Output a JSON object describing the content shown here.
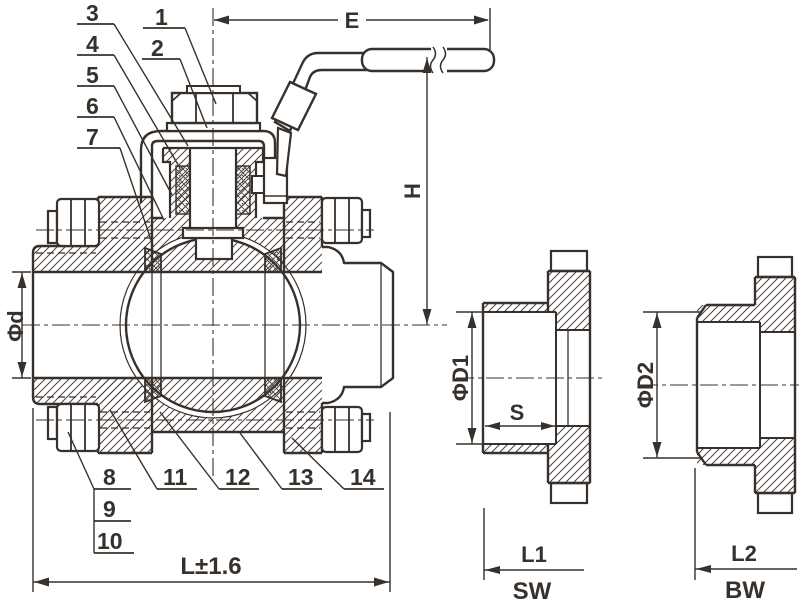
{
  "part_labels": {
    "p1": "1",
    "p2": "2",
    "p3": "3",
    "p4": "4",
    "p5": "5",
    "p6": "6",
    "p7": "7",
    "p8": "8",
    "p9": "9",
    "p10": "10",
    "p11": "11",
    "p12": "12",
    "p13": "13",
    "p14": "14"
  },
  "dim_labels": {
    "e": "E",
    "h": "H",
    "phi_d": "Φd",
    "length_tol": "L±1.6",
    "phi_d1": "ΦD1",
    "s": "S",
    "l1": "L1",
    "sw": "SW",
    "phi_d2": "ΦD2",
    "l2": "L2",
    "bw": "BW"
  },
  "colors": {
    "ink": "#38302a",
    "background": "#ffffff"
  }
}
